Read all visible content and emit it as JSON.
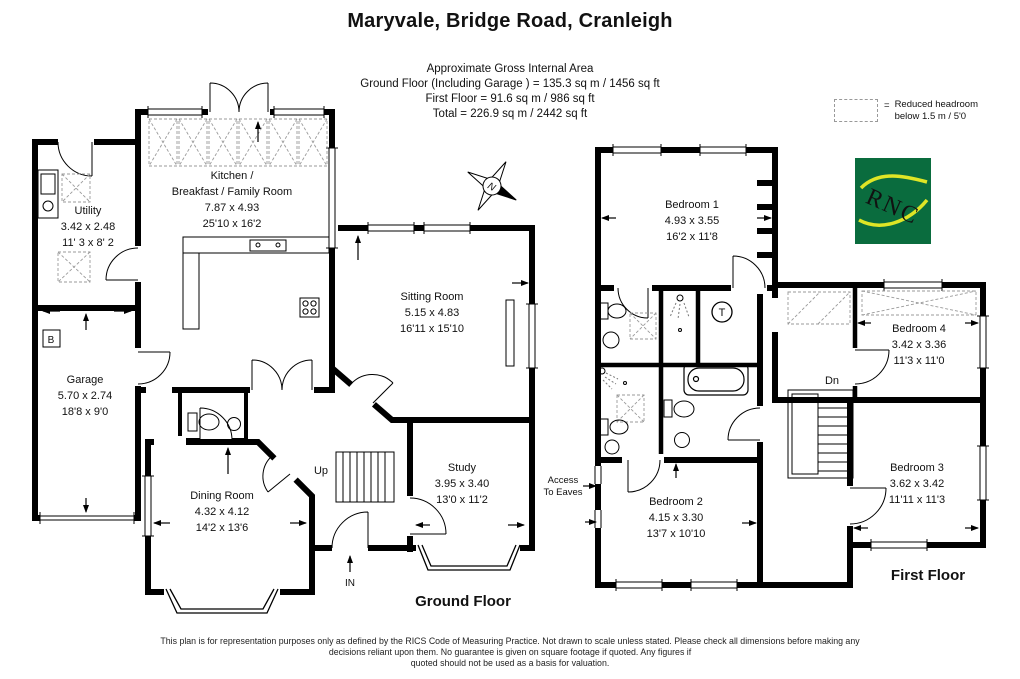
{
  "title": "Maryvale, Bridge Road, Cranleigh",
  "area_summary": {
    "heading": "Approximate Gross Internal Area",
    "ground_line": "Ground Floor (Including Garage ) = 135.3 sq m / 1456 sq ft",
    "first_line": "First Floor = 91.6 sq m / 986 sq ft",
    "total_line": "Total = 226.9 sq m / 2442 sq ft"
  },
  "legend": {
    "equals": "=",
    "line1": "Reduced headroom",
    "line2": "below 1.5 m / 5'0"
  },
  "compass": {
    "north": "N"
  },
  "logo": {
    "text": "RNC"
  },
  "ground_floor": {
    "floor_label": "Ground Floor",
    "rooms": {
      "kitchen": {
        "name1": "Kitchen /",
        "name2": "Breakfast / Family Room",
        "metric": "7.87 x 4.93",
        "imperial": "25'10 x 16'2"
      },
      "utility": {
        "name": "Utility",
        "metric": "3.42 x 2.48",
        "imperial": "11' 3 x 8' 2"
      },
      "garage": {
        "name": "Garage",
        "metric": "5.70 x 2.74",
        "imperial": "18'8 x 9'0"
      },
      "sitting_room": {
        "name": "Sitting Room",
        "metric": "5.15 x 4.83",
        "imperial": "16'11 x 15'10"
      },
      "dining_room": {
        "name": "Dining Room",
        "metric": "4.32 x 4.12",
        "imperial": "14'2 x 13'6"
      },
      "study": {
        "name": "Study",
        "metric": "3.95 x 3.40",
        "imperial": "13'0 x 11'2"
      }
    },
    "annotations": {
      "up": "Up",
      "entrance": "IN",
      "boiler": "B"
    }
  },
  "first_floor": {
    "floor_label": "First Floor",
    "rooms": {
      "bedroom1": {
        "name": "Bedroom 1",
        "metric": "4.93 x 3.55",
        "imperial": "16'2 x 11'8"
      },
      "bedroom2": {
        "name": "Bedroom 2",
        "metric": "4.15 x 3.30",
        "imperial": "13'7 x 10'10"
      },
      "bedroom3": {
        "name": "Bedroom 3",
        "metric": "3.62 x 3.42",
        "imperial": "11'11 x 11'3"
      },
      "bedroom4": {
        "name": "Bedroom 4",
        "metric": "3.42 x 3.36",
        "imperial": "11'3 x 11'0"
      }
    },
    "annotations": {
      "down": "Dn",
      "tank": "T",
      "access_line1": "Access",
      "access_line2": "To Eaves"
    }
  },
  "footer": {
    "line1": "This plan is for representation purposes only as defined by the RICS Code of Measuring Practice. Not drawn to scale unless stated. Please check all dimensions before making any",
    "line2": "decisions reliant upon them. No guarantee is given on square footage if quoted. Any figures if",
    "line3": "quoted should not be used as a basis for valuation."
  },
  "colors": {
    "walls": "#000000",
    "logo_green": "#0a6c3e",
    "logo_yellow": "#dfe526",
    "dash_gray": "#9a9a9a"
  }
}
